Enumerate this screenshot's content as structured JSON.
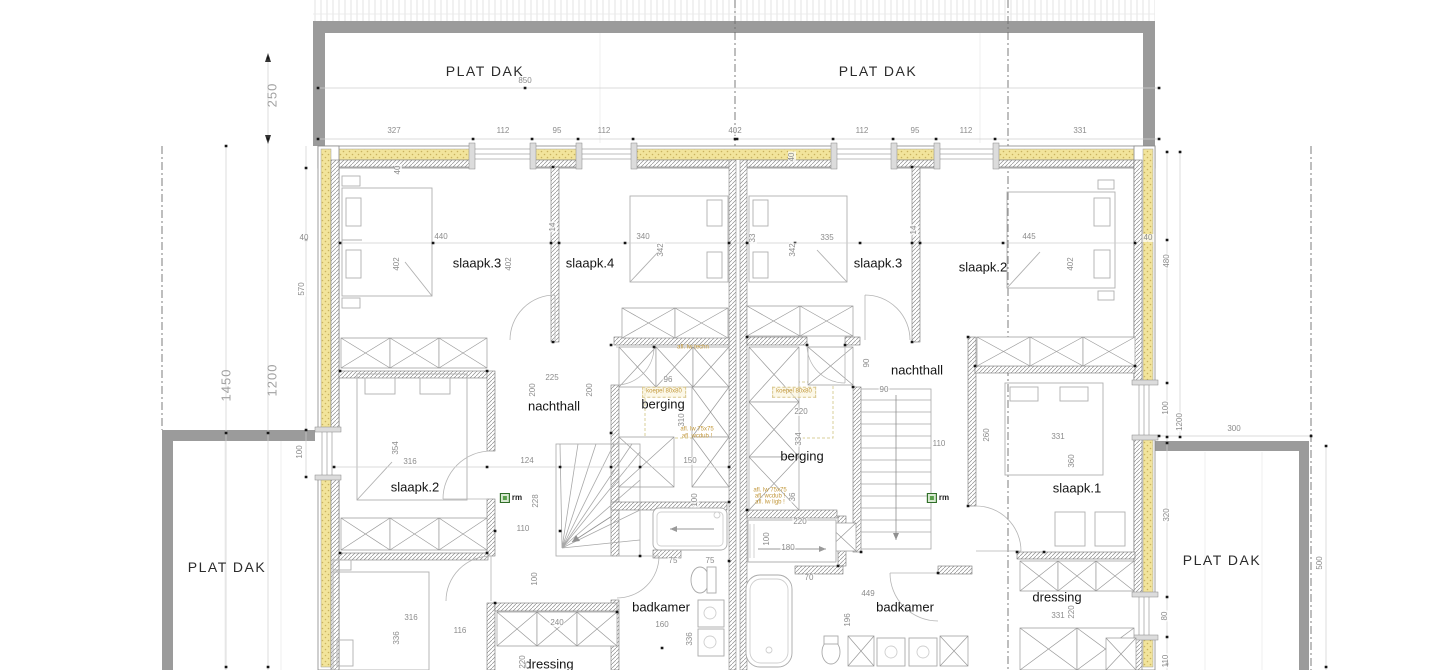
{
  "colors": {
    "roof_gray": "#9b9b9b",
    "insulation_yellow": "#f2e49b",
    "insulation_dot": "#c9b25f",
    "wall_hatch": "#8f8f8f",
    "wall_edge": "#777777",
    "dim_text": "#8c8c8c",
    "dim_line": "#cfcfcf",
    "label_text": "#141414",
    "annotation_yellow": "#c2983c",
    "marker_green": "#5aa04c",
    "furniture_line": "#b0b0b0",
    "dot_black": "#161616"
  },
  "plat_dak_labels": [
    {
      "text": "PLAT DAK",
      "x": 485,
      "y": 71
    },
    {
      "text": "PLAT DAK",
      "x": 878,
      "y": 71
    },
    {
      "text": "PLAT DAK",
      "x": 227,
      "y": 567
    },
    {
      "text": "PLAT DAK",
      "x": 1222,
      "y": 560
    }
  ],
  "room_labels": [
    {
      "text": "slaapk.3",
      "x": 477,
      "y": 263
    },
    {
      "text": "slaapk.4",
      "x": 590,
      "y": 263
    },
    {
      "text": "slaapk.3",
      "x": 878,
      "y": 263
    },
    {
      "text": "slaapk.2",
      "x": 983,
      "y": 267
    },
    {
      "text": "nachthall",
      "x": 554,
      "y": 406
    },
    {
      "text": "berging",
      "x": 663,
      "y": 404
    },
    {
      "text": "nachthall",
      "x": 917,
      "y": 370
    },
    {
      "text": "berging",
      "x": 802,
      "y": 456
    },
    {
      "text": "slaapk.2",
      "x": 415,
      "y": 487
    },
    {
      "text": "slaapk.1",
      "x": 1077,
      "y": 488
    },
    {
      "text": "badkamer",
      "x": 661,
      "y": 607
    },
    {
      "text": "badkamer",
      "x": 905,
      "y": 607
    },
    {
      "text": "dressing",
      "x": 549,
      "y": 664
    },
    {
      "text": "dressing",
      "x": 1057,
      "y": 597
    }
  ],
  "dim_labels": [
    {
      "t": "327",
      "x": 394,
      "y": 131
    },
    {
      "t": "112",
      "x": 503,
      "y": 131
    },
    {
      "t": "95",
      "x": 557,
      "y": 131
    },
    {
      "t": "112",
      "x": 604,
      "y": 131
    },
    {
      "t": "402",
      "x": 735,
      "y": 131
    },
    {
      "t": "112",
      "x": 862,
      "y": 131
    },
    {
      "t": "95",
      "x": 915,
      "y": 131
    },
    {
      "t": "112",
      "x": 966,
      "y": 131
    },
    {
      "t": "331",
      "x": 1080,
      "y": 131
    },
    {
      "t": "850",
      "x": 525,
      "y": 81
    },
    {
      "t": "440",
      "x": 441,
      "y": 237
    },
    {
      "t": "340",
      "x": 643,
      "y": 237
    },
    {
      "t": "335",
      "x": 827,
      "y": 238
    },
    {
      "t": "445",
      "x": 1029,
      "y": 237
    },
    {
      "t": "402",
      "x": 397,
      "y": 264,
      "r": 1
    },
    {
      "t": "402",
      "x": 509,
      "y": 264,
      "r": 1
    },
    {
      "t": "342",
      "x": 661,
      "y": 250,
      "r": 1
    },
    {
      "t": "342",
      "x": 793,
      "y": 250,
      "r": 1
    },
    {
      "t": "402",
      "x": 1071,
      "y": 264,
      "r": 1
    },
    {
      "t": "33",
      "x": 753,
      "y": 238,
      "r": 1
    },
    {
      "t": "40",
      "x": 398,
      "y": 170,
      "r": 1
    },
    {
      "t": "40",
      "x": 792,
      "y": 157,
      "r": 1
    },
    {
      "t": "14",
      "x": 553,
      "y": 227,
      "r": 1
    },
    {
      "t": "14",
      "x": 914,
      "y": 230,
      "r": 1
    },
    {
      "t": "40",
      "x": 304,
      "y": 238
    },
    {
      "t": "40",
      "x": 1148,
      "y": 238
    },
    {
      "t": "570",
      "x": 302,
      "y": 289,
      "r": 1
    },
    {
      "t": "480",
      "x": 1167,
      "y": 261,
      "r": 1
    },
    {
      "t": "250",
      "x": 272,
      "y": 95,
      "r": 1,
      "big": 1
    },
    {
      "t": "1450",
      "x": 226,
      "y": 385,
      "r": 1,
      "big": 1
    },
    {
      "t": "1200",
      "x": 272,
      "y": 380,
      "r": 1,
      "big": 1
    },
    {
      "t": "100",
      "x": 300,
      "y": 452,
      "r": 1
    },
    {
      "t": "225",
      "x": 552,
      "y": 378
    },
    {
      "t": "96",
      "x": 668,
      "y": 380
    },
    {
      "t": "200",
      "x": 533,
      "y": 390,
      "r": 1
    },
    {
      "t": "200",
      "x": 590,
      "y": 390,
      "r": 1
    },
    {
      "t": "310",
      "x": 682,
      "y": 420,
      "r": 1
    },
    {
      "t": "150",
      "x": 690,
      "y": 461
    },
    {
      "t": "124",
      "x": 527,
      "y": 461
    },
    {
      "t": "316",
      "x": 410,
      "y": 462
    },
    {
      "t": "354",
      "x": 396,
      "y": 448,
      "r": 1
    },
    {
      "t": "228",
      "x": 536,
      "y": 501,
      "r": 1
    },
    {
      "t": "110",
      "x": 523,
      "y": 529
    },
    {
      "t": "90",
      "x": 867,
      "y": 363,
      "r": 1
    },
    {
      "t": "90",
      "x": 884,
      "y": 390
    },
    {
      "t": "110",
      "x": 939,
      "y": 444
    },
    {
      "t": "260",
      "x": 987,
      "y": 435,
      "r": 1
    },
    {
      "t": "220",
      "x": 801,
      "y": 412
    },
    {
      "t": "334",
      "x": 799,
      "y": 439,
      "r": 1
    },
    {
      "t": "36",
      "x": 793,
      "y": 497,
      "r": 1
    },
    {
      "t": "331",
      "x": 1058,
      "y": 437
    },
    {
      "t": "360",
      "x": 1072,
      "y": 461,
      "r": 1
    },
    {
      "t": "100",
      "x": 1166,
      "y": 408,
      "r": 1
    },
    {
      "t": "1200",
      "x": 1180,
      "y": 422,
      "r": 1
    },
    {
      "t": "300",
      "x": 1234,
      "y": 429
    },
    {
      "t": "320",
      "x": 1167,
      "y": 515,
      "r": 1
    },
    {
      "t": "80",
      "x": 1165,
      "y": 616,
      "r": 1
    },
    {
      "t": "110",
      "x": 1166,
      "y": 661,
      "r": 1
    },
    {
      "t": "500",
      "x": 1320,
      "y": 563,
      "r": 1
    },
    {
      "t": "220",
      "x": 800,
      "y": 522
    },
    {
      "t": "100",
      "x": 767,
      "y": 539,
      "r": 1
    },
    {
      "t": "180",
      "x": 788,
      "y": 548
    },
    {
      "t": "70",
      "x": 809,
      "y": 578
    },
    {
      "t": "449",
      "x": 868,
      "y": 594
    },
    {
      "t": "196",
      "x": 848,
      "y": 620,
      "r": 1
    },
    {
      "t": "75",
      "x": 673,
      "y": 561
    },
    {
      "t": "75",
      "x": 710,
      "y": 561
    },
    {
      "t": "100",
      "x": 695,
      "y": 500,
      "r": 1
    },
    {
      "t": "100",
      "x": 535,
      "y": 579,
      "r": 1
    },
    {
      "t": "160",
      "x": 662,
      "y": 625
    },
    {
      "t": "336",
      "x": 690,
      "y": 639,
      "r": 1
    },
    {
      "t": "240",
      "x": 557,
      "y": 623
    },
    {
      "t": "316",
      "x": 411,
      "y": 618
    },
    {
      "t": "336",
      "x": 397,
      "y": 638,
      "r": 1
    },
    {
      "t": "116",
      "x": 460,
      "y": 631
    },
    {
      "t": "220",
      "x": 523,
      "y": 662,
      "r": 1
    },
    {
      "t": "331",
      "x": 1058,
      "y": 616
    },
    {
      "t": "220",
      "x": 1072,
      "y": 612,
      "r": 1
    }
  ],
  "annotations": [
    {
      "t": "afl. lw techn",
      "x": 693,
      "y": 348
    },
    {
      "t": "koepel 80x80",
      "x": 664,
      "y": 392,
      "box": 1
    },
    {
      "t": "koepel 80x80",
      "x": 794,
      "y": 392,
      "box": 1
    },
    {
      "t": "afl. lw 75x75",
      "x": 697,
      "y": 430
    },
    {
      "t": "afl. wcdub !",
      "x": 697,
      "y": 437
    },
    {
      "t": "afl. lw 75x75",
      "x": 770,
      "y": 491
    },
    {
      "t": "afl. wcdub !",
      "x": 770,
      "y": 497
    },
    {
      "t": "afl. lw ligb !",
      "x": 770,
      "y": 503
    }
  ],
  "markers": [
    {
      "t": "rm",
      "x": 511,
      "y": 498
    },
    {
      "t": "rm",
      "x": 938,
      "y": 498
    }
  ]
}
